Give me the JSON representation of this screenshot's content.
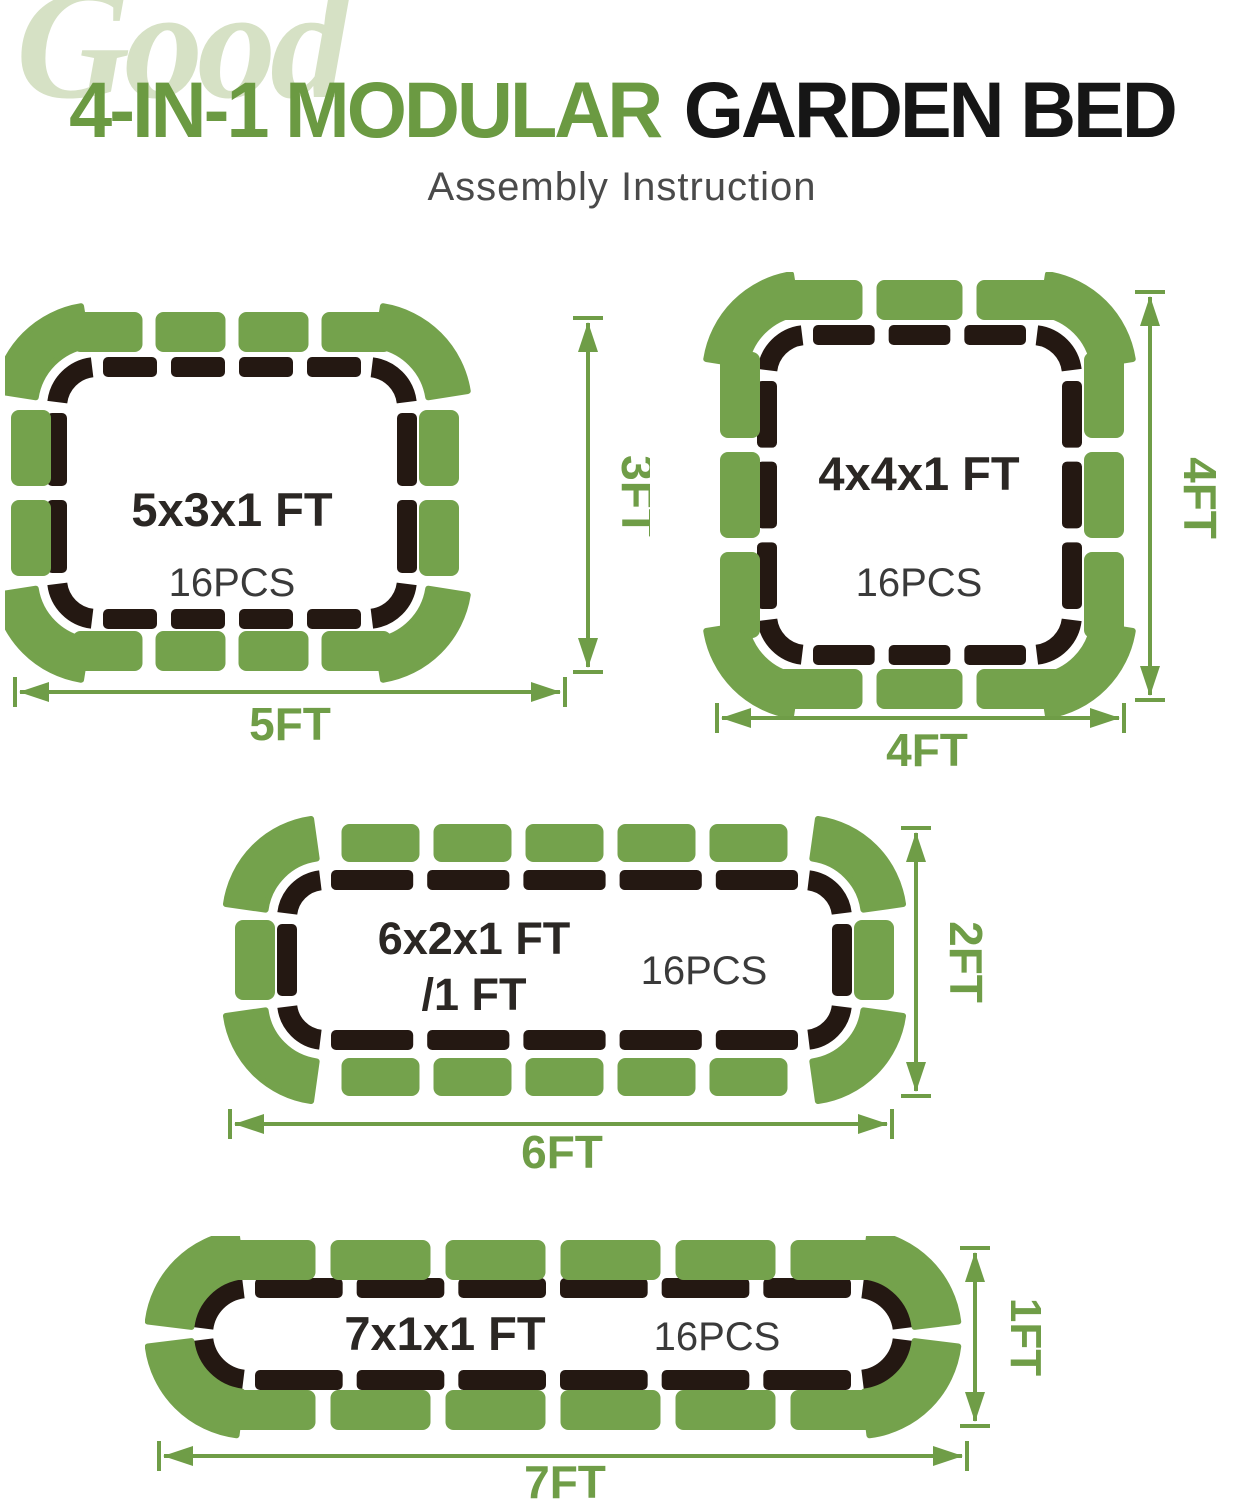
{
  "header": {
    "decorative_word": "Good",
    "title_part1": "4-IN-1 MODULAR",
    "title_part2": "GARDEN BED",
    "subtitle": "Assembly Instruction"
  },
  "colors": {
    "panel_green": "#74a24c",
    "dim_green": "#6f9d47",
    "title_green": "#6b9a42",
    "pale_green": "#d6e1c5",
    "dark_border": "#241812",
    "label_dark": "#2b2724",
    "pcs_dark": "#3a3a3a",
    "subtitle_gray": "#4a4a4a",
    "title_black": "#161616"
  },
  "beds": [
    {
      "name": "5x3 bed",
      "size_label": "5x3x1 FT",
      "pcs_label": "16PCS",
      "width_label": "5FT",
      "height_label": "3FT",
      "pieces": {
        "top": 4,
        "bottom": 4,
        "left": 2,
        "right": 2,
        "corners": 4,
        "total": 16
      }
    },
    {
      "name": "4x4 bed",
      "size_label": "4x4x1 FT",
      "pcs_label": "16PCS",
      "width_label": "4FT",
      "height_label": "4FT",
      "pieces": {
        "top": 3,
        "bottom": 3,
        "left": 3,
        "right": 3,
        "corners": 4,
        "total": 16
      }
    },
    {
      "name": "6x2 bed",
      "size_label": "6x2x1 FT",
      "size_label_line2": "/1 FT",
      "pcs_label": "16PCS",
      "width_label": "6FT",
      "height_label": "2FT",
      "pieces": {
        "top": 5,
        "bottom": 5,
        "left": 1,
        "right": 1,
        "corners": 4,
        "total": 16
      }
    },
    {
      "name": "7x1 bed",
      "size_label": "7x1x1 FT",
      "pcs_label": "16PCS",
      "width_label": "7FT",
      "height_label": "1FT",
      "pieces": {
        "top": 6,
        "bottom": 6,
        "left": 0,
        "right": 0,
        "corners": 4,
        "total": 16
      }
    }
  ]
}
